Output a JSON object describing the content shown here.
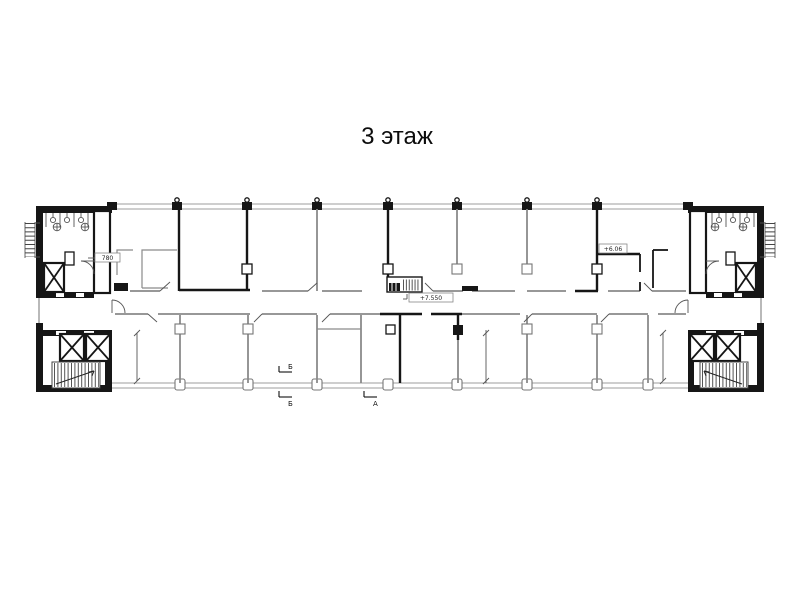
{
  "title": "3 этаж",
  "plan": {
    "labels": {
      "room_left": "780",
      "elevation_center": "+7.550",
      "elevation_right": "+6.06",
      "section_b_top": "Б",
      "section_b_bottom": "Б",
      "section_a": "А"
    },
    "colors": {
      "wall": "#161616",
      "partition": "#8a8a8a",
      "facade": "#9c9c9c",
      "background": "#ffffff"
    }
  }
}
